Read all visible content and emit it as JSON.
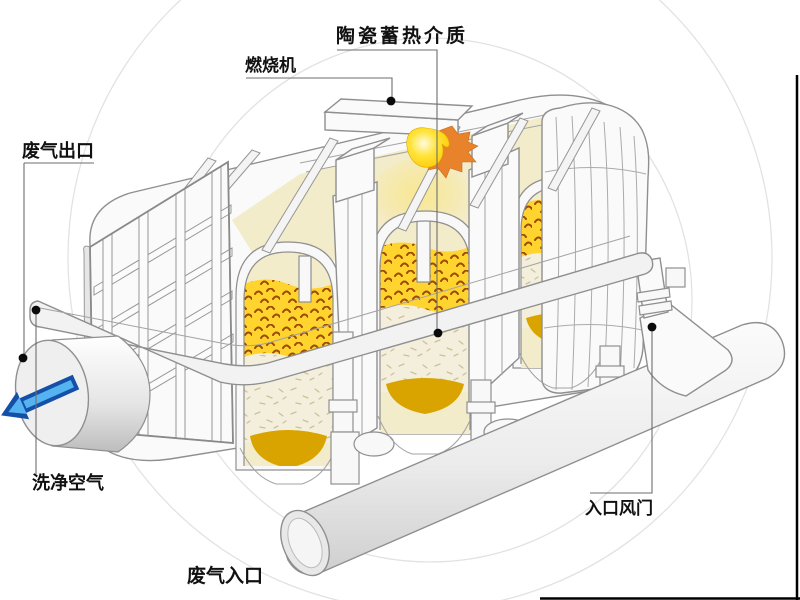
{
  "labels": {
    "ceramic_media": "陶瓷蓄热介质",
    "burner": "燃烧机",
    "waste_gas_outlet": "废气出口",
    "clean_air": "洗净空气",
    "waste_gas_inlet": "废气入口",
    "inlet_damper": "入口风门"
  },
  "colors": {
    "flame_orange": "#e8832b",
    "flame_yellow": "#ffd91e",
    "media_yellow": "#ffd42e",
    "media_speckle": "#9c4a00",
    "media_cream": "#f3ecca",
    "media_white": "#f4efdc",
    "media_gold": "#d9a400",
    "machine_line": "#8f8f8f",
    "arrow_blue_dark": "#1450a8",
    "arrow_blue_light": "#55b4f0"
  }
}
